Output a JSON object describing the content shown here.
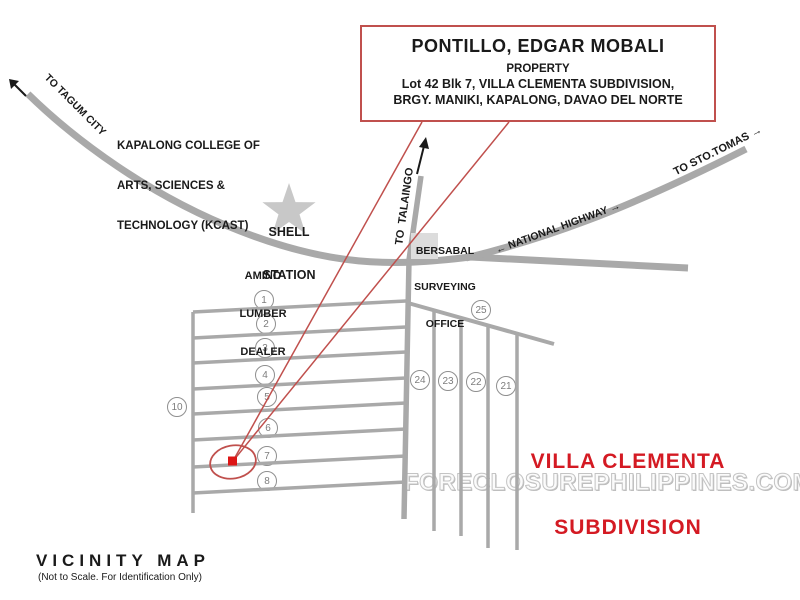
{
  "title_box": {
    "owner": "PONTILLO, EDGAR MOBALI",
    "subtitle": "PROPERTY",
    "address_line1": "Lot 42 Blk 7, VILLA CLEMENTA SUBDIVISION,",
    "address_line2": "BRGY. MANIKI, KAPALONG, DAVAO DEL NORTE"
  },
  "road_labels": {
    "to_tagum": "TO TAGUM CITY",
    "to_sto_tomas": "TO STO.TOMAS →",
    "national_highway": "← NATIONAL HIGHWAY →",
    "to_talaingo": "TO  TALAINGO"
  },
  "landmarks": {
    "kcast": [
      "KAPALONG COLLEGE OF",
      "ARTS, SCIENCES &",
      "TECHNOLOGY (KCAST)"
    ],
    "shell": [
      "SHELL",
      "STATION"
    ],
    "amino": [
      "AMINO",
      "LUMBER",
      "DEALER"
    ],
    "bersabal": [
      "BERSABAL",
      "SURVEYING",
      "OFFICE"
    ]
  },
  "subdivision": {
    "title_line1": "VILLA CLEMENTA",
    "title_line2": "SUBDIVISION",
    "block_labels": [
      "1",
      "2",
      "3",
      "4",
      "5",
      "6",
      "7",
      "8",
      "10",
      "25",
      "24",
      "23",
      "22",
      "21"
    ]
  },
  "watermark": "FORECLOSUREPHILIPPINES.COM",
  "footer": {
    "title": "VICINITY MAP",
    "note": "(Not to Scale. For Identification Only)"
  },
  "colors": {
    "road_gray": "#a9a9a9",
    "accent_red": "#c0504d",
    "marker_red": "#dd1515",
    "subdivision_red": "#d41a23"
  }
}
